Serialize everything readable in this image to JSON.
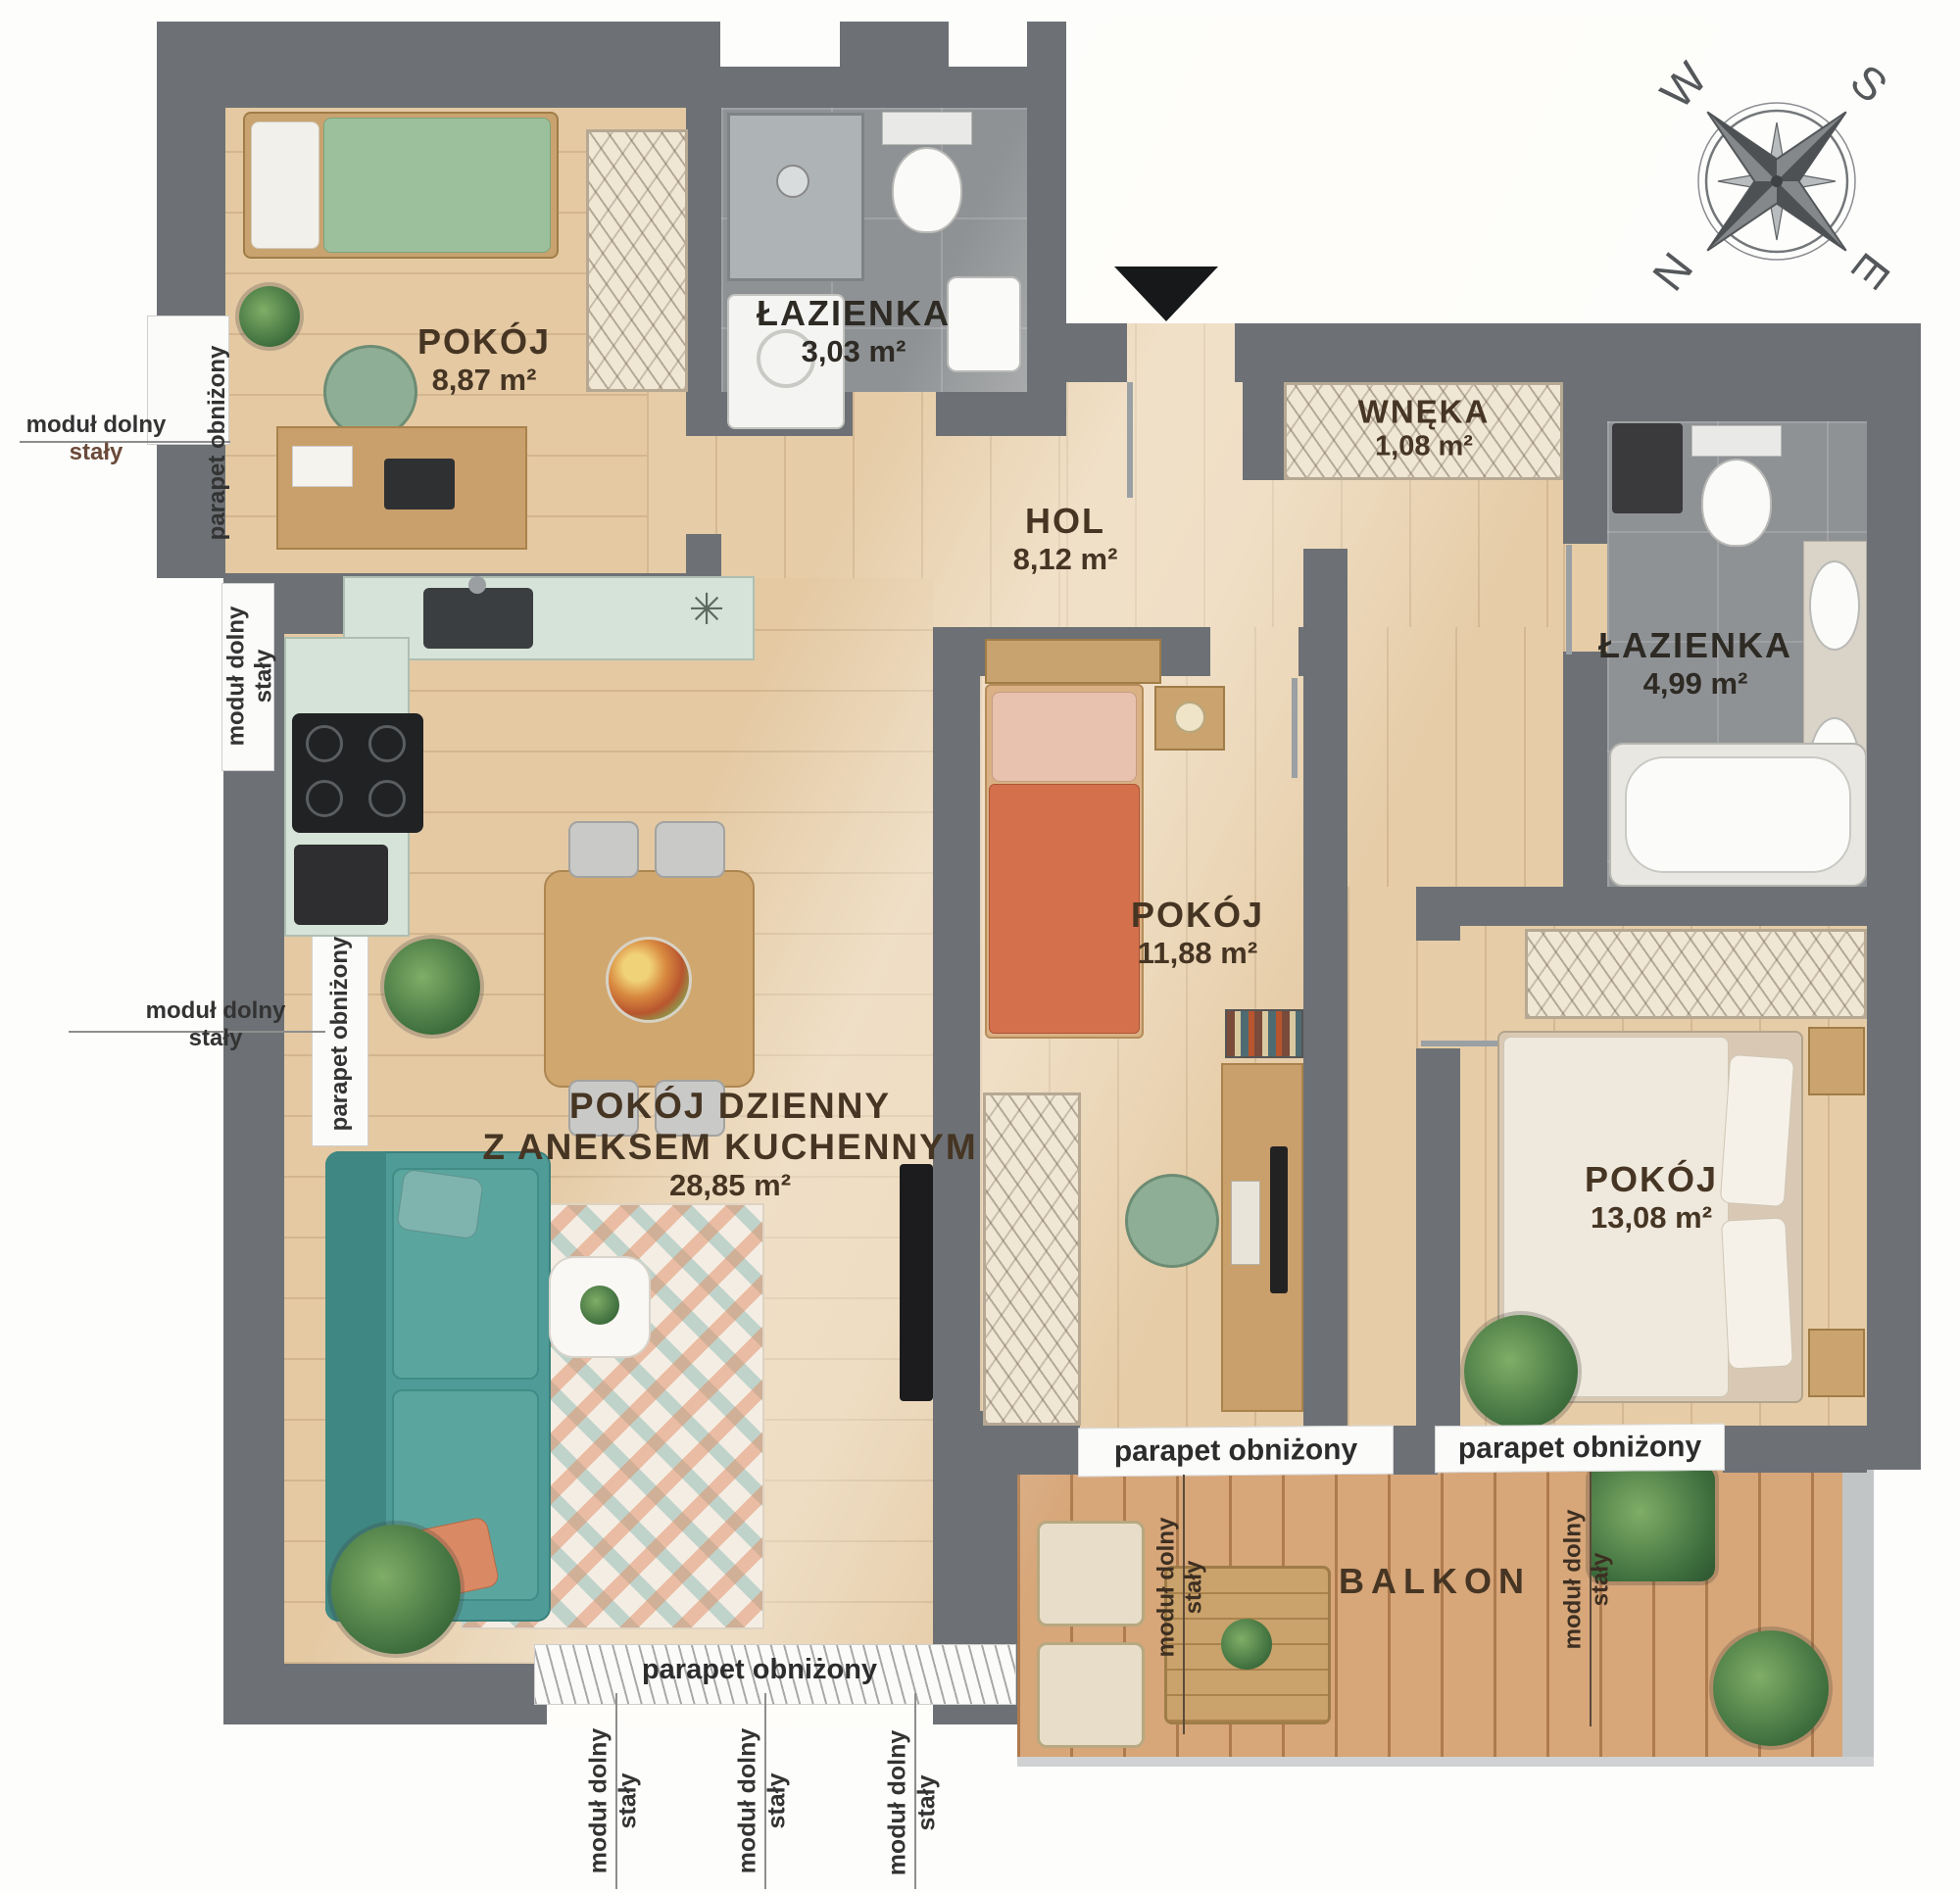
{
  "rooms": {
    "pokoj1": {
      "name": "POKÓJ",
      "area": "8,87 m²"
    },
    "lazienka1": {
      "name": "ŁAZIENKA",
      "area": "3,03 m²"
    },
    "wneka": {
      "name": "WNĘKA",
      "area": "1,08 m²"
    },
    "hol": {
      "name": "HOL",
      "area": "8,12 m²"
    },
    "lazienka2": {
      "name": "ŁAZIENKA",
      "area": "4,99 m²"
    },
    "pokoj2": {
      "name": "POKÓJ",
      "area": "11,88 m²"
    },
    "pokoj3": {
      "name": "POKÓJ",
      "area": "13,08 m²"
    },
    "salon": {
      "name_line1": "POKÓJ DZIENNY",
      "name_line2": "Z ANEKSEM KUCHENNYM",
      "area": "28,85 m²"
    },
    "balkon": {
      "name": "BALKON"
    }
  },
  "annotations": {
    "modul_line1": "moduł dolny",
    "modul_line2": "stały",
    "parapet": "parapet obniżony"
  },
  "compass": {
    "west": "W",
    "south": "S",
    "north": "N",
    "east": "E"
  },
  "colors": {
    "wall": "#6d7175",
    "wood_floor": "#e4c9a3",
    "balcony_floor": "#d7a679",
    "tile_floor": "#8f9295",
    "sofa_teal": "#4f9b97",
    "bed_orange": "#d4704c",
    "bed_green": "#9cc09c",
    "label_brown": "#463523"
  }
}
